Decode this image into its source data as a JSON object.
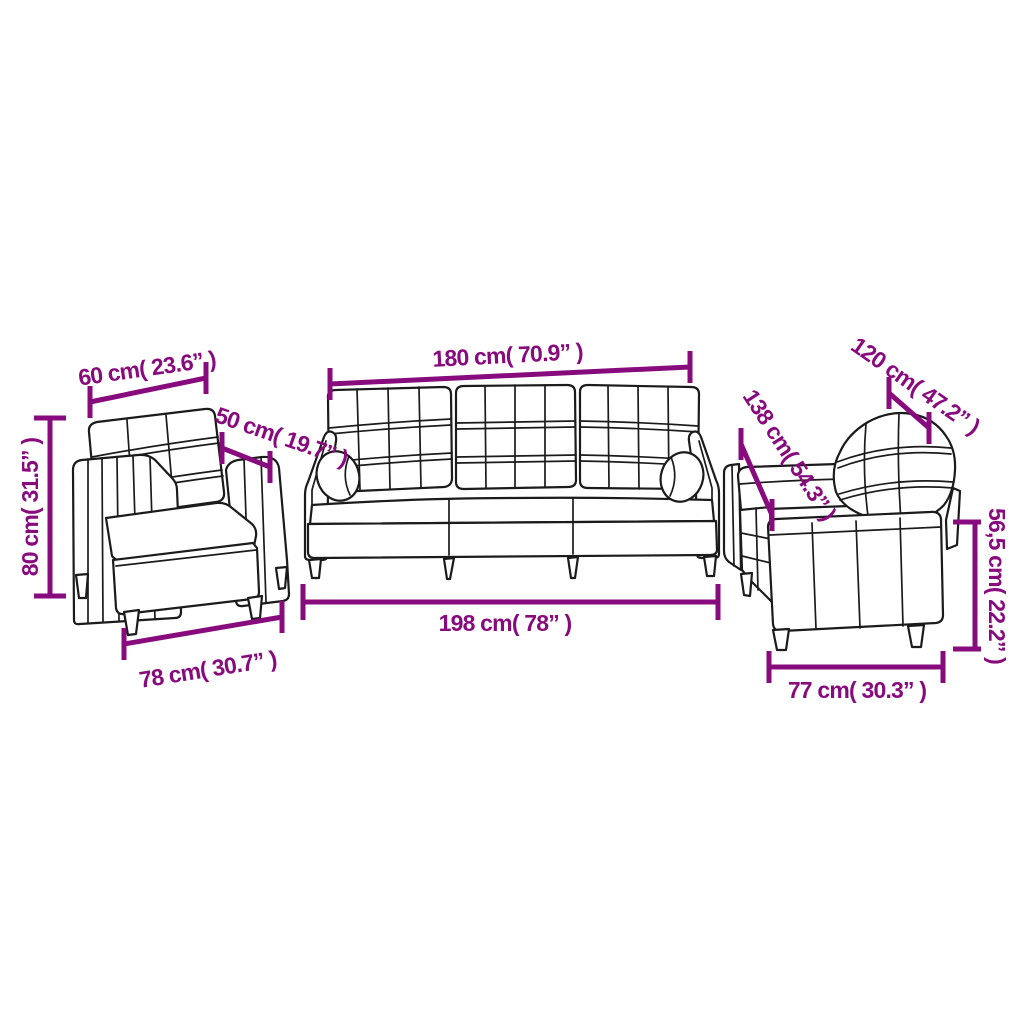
{
  "diagram": {
    "type": "product-dimension-diagram",
    "product": "3 piece sofa set with cushions",
    "accent_color": "#870b7d",
    "outline_color": "#1b1b1b",
    "background_color": "#ffffff",
    "pieces": [
      {
        "name": "armchair",
        "view": "front three-quarter line drawing",
        "dimension_keys": [
          "armchair_back_width",
          "armchair_height",
          "armchair_depth",
          "armchair_base_width"
        ]
      },
      {
        "name": "three-seater sofa",
        "view": "front line drawing with two bolster cushions",
        "dimension_keys": [
          "sofa3_back_width",
          "sofa3_base_width"
        ]
      },
      {
        "name": "two-seater sofa",
        "view": "rear three-quarter line drawing",
        "dimension_keys": [
          "sofa2_depth",
          "sofa2_diagonal_depth",
          "sofa2_seat_height",
          "sofa2_base_width"
        ]
      }
    ]
  },
  "measurements": {
    "armchair_back_width": "60 cm( 23.6” )",
    "armchair_height": "80 cm( 31.5” )",
    "armchair_depth": "50 cm( 19.7” )",
    "armchair_base_width": "78 cm( 30.7” )",
    "sofa3_back_width": "180 cm( 70.9” )",
    "sofa3_base_width": "198 cm( 78” )",
    "sofa2_depth": "120 cm( 47.2” )",
    "sofa2_diagonal_depth": "138 cm( 54.3” )",
    "sofa2_seat_height": "56,5 cm( 22.2” )",
    "sofa2_base_width": "77 cm( 30.3” )"
  }
}
